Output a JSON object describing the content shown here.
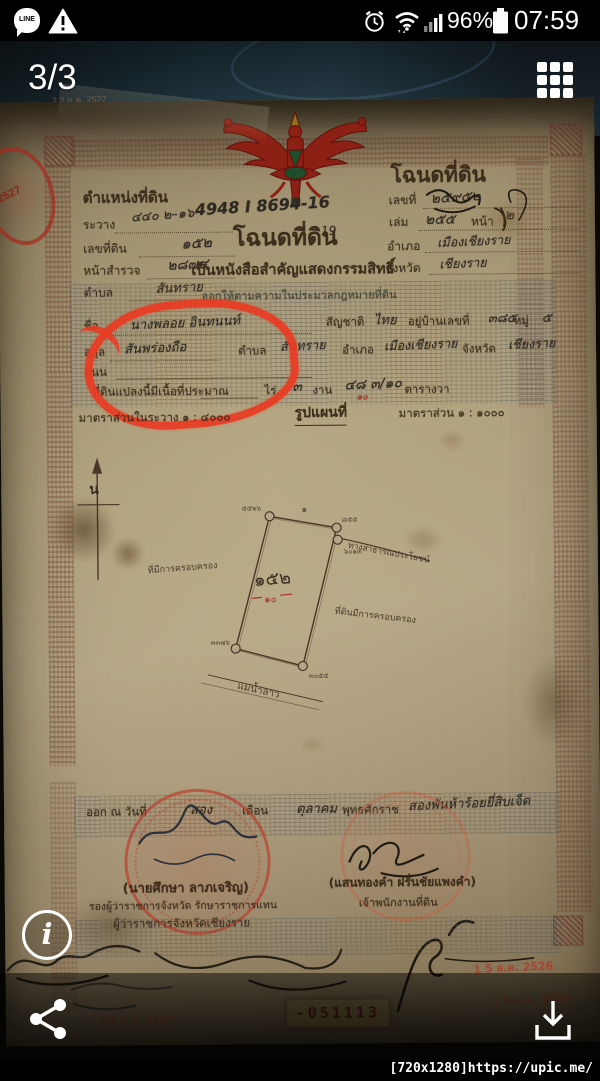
{
  "status_bar": {
    "time": "07:59",
    "battery_percent": "96%",
    "line_icon_label": "LINE"
  },
  "viewer": {
    "page_indicator": "3/3",
    "watermark": "[720x1280]https://upic.me/"
  },
  "doc": {
    "left_header": "ตำแหน่งที่ดิน",
    "left_fields": [
      {
        "label": "ระวาง",
        "value": "๔๔๐ ๒–๑๖"
      },
      {
        "label": "เลขที่ดิน",
        "value": "๑๕๒"
      },
      {
        "label": "หน้าสำรวจ",
        "value": "๒๘๗๔"
      },
      {
        "label": "ตำบล",
        "value": "สันทราย"
      }
    ],
    "survey_code": "4948 I 8694-16",
    "survey_sub": "19",
    "right_header": "โฉนดที่ดิน",
    "right_fields": [
      {
        "label": "เลขที่",
        "value": "๒๕๙๕๒"
      },
      {
        "label": "เล่ม",
        "value": "๒๕๕"
      },
      {
        "label": "หน้า",
        "value": "๒"
      },
      {
        "label": "อำเภอ",
        "value": "เมืองเชียงราย"
      },
      {
        "label": "จังหวัด",
        "value": "เชียงราย"
      }
    ],
    "title": "โฉนดที่ดิน",
    "subtitle": "เป็นหนังสือสำคัญแสดงกรรมสิทธิ์",
    "subtitle2": "ออกให้ตามความในประมวลกฎหมายที่ดิน",
    "owner": {
      "name_label": "ชื่อ",
      "name": "นางพลอย อินทนนท์",
      "nationality_label": "สัญชาติ",
      "nationality": "ไทย",
      "address_label": "อยู่บ้านเลขที่",
      "address_no": "๓๘๕",
      "moo_label": "หมู่",
      "moo": "๕",
      "row2_label": "สกุล",
      "row2_value": "สันพร่องถือ",
      "tambon_label": "ตำบล",
      "tambon": "สันทราย",
      "amphoe_label": "อำเภอ",
      "amphoe": "เมืองเชียงราย",
      "changwat_label": "จังหวัด",
      "changwat": "เชียงราย",
      "row3_label": "ถนน"
    },
    "area": {
      "label": "ที่ดินแปลงนี้มีเนื้อที่ประมาณ",
      "rai_label": "ไร่",
      "ngan": "๓",
      "ngan_label": "งาน",
      "wa": "๔๘ ๓/๑๐",
      "wa_red": "๑๐",
      "wa_label": "ตารางวา"
    },
    "scale_left": "มาตราส่วนในระวาง ๑ : ๔๐๐๐",
    "map_title": "รูปแผนที่",
    "scale_right": "มาตราส่วน ๑ : ๑๐๐๐",
    "map": {
      "north": "น",
      "parcel_no": "๑๕๒",
      "parcel_red": "๑๐",
      "mark": "๑",
      "road_label": "ทางสาธารณประโยชน์",
      "left_label": "ที่มีการครอบครอง",
      "right_label": "ที่ดินมีการครอบครอง",
      "bottom_label": "แม่น้ำลาว",
      "markers": [
        "๕๕๒๖",
        "๘๕๕",
        "๖๐๑๓",
        "๓๓๗๖",
        "๓๐๕๕"
      ]
    },
    "issue": {
      "prefix": "ออก ณ วันที่",
      "day": "สอง",
      "month_label": "เดือน",
      "month": "ตุลาคม",
      "era": "พุทธศักราช",
      "year": "สองพันห้าร้อยยี่สิบเจ็ด"
    },
    "sign_left": {
      "name": "(นายศึกษา ลาภเจริญ)",
      "title1": "รองผู้ว่าราชการจังหวัด รักษาราชการแทน",
      "title2": "ผู้ว่าราชการจังหวัดเชียงราย"
    },
    "sign_right": {
      "name": "(แสนทองคำ ฝรั่นชัยแพงคำ)",
      "title": "เจ้าพนักงานที่ดิน"
    },
    "serial": "-051113",
    "stamps": {
      "date1": "1 5 ส.ค. 2526",
      "date2": "1 9 ส.ค. 2526",
      "date3": "1 1 ก.ค. 2527",
      "top": "2 2 ม.ค. 2527",
      "edge_year": "2527"
    }
  }
}
